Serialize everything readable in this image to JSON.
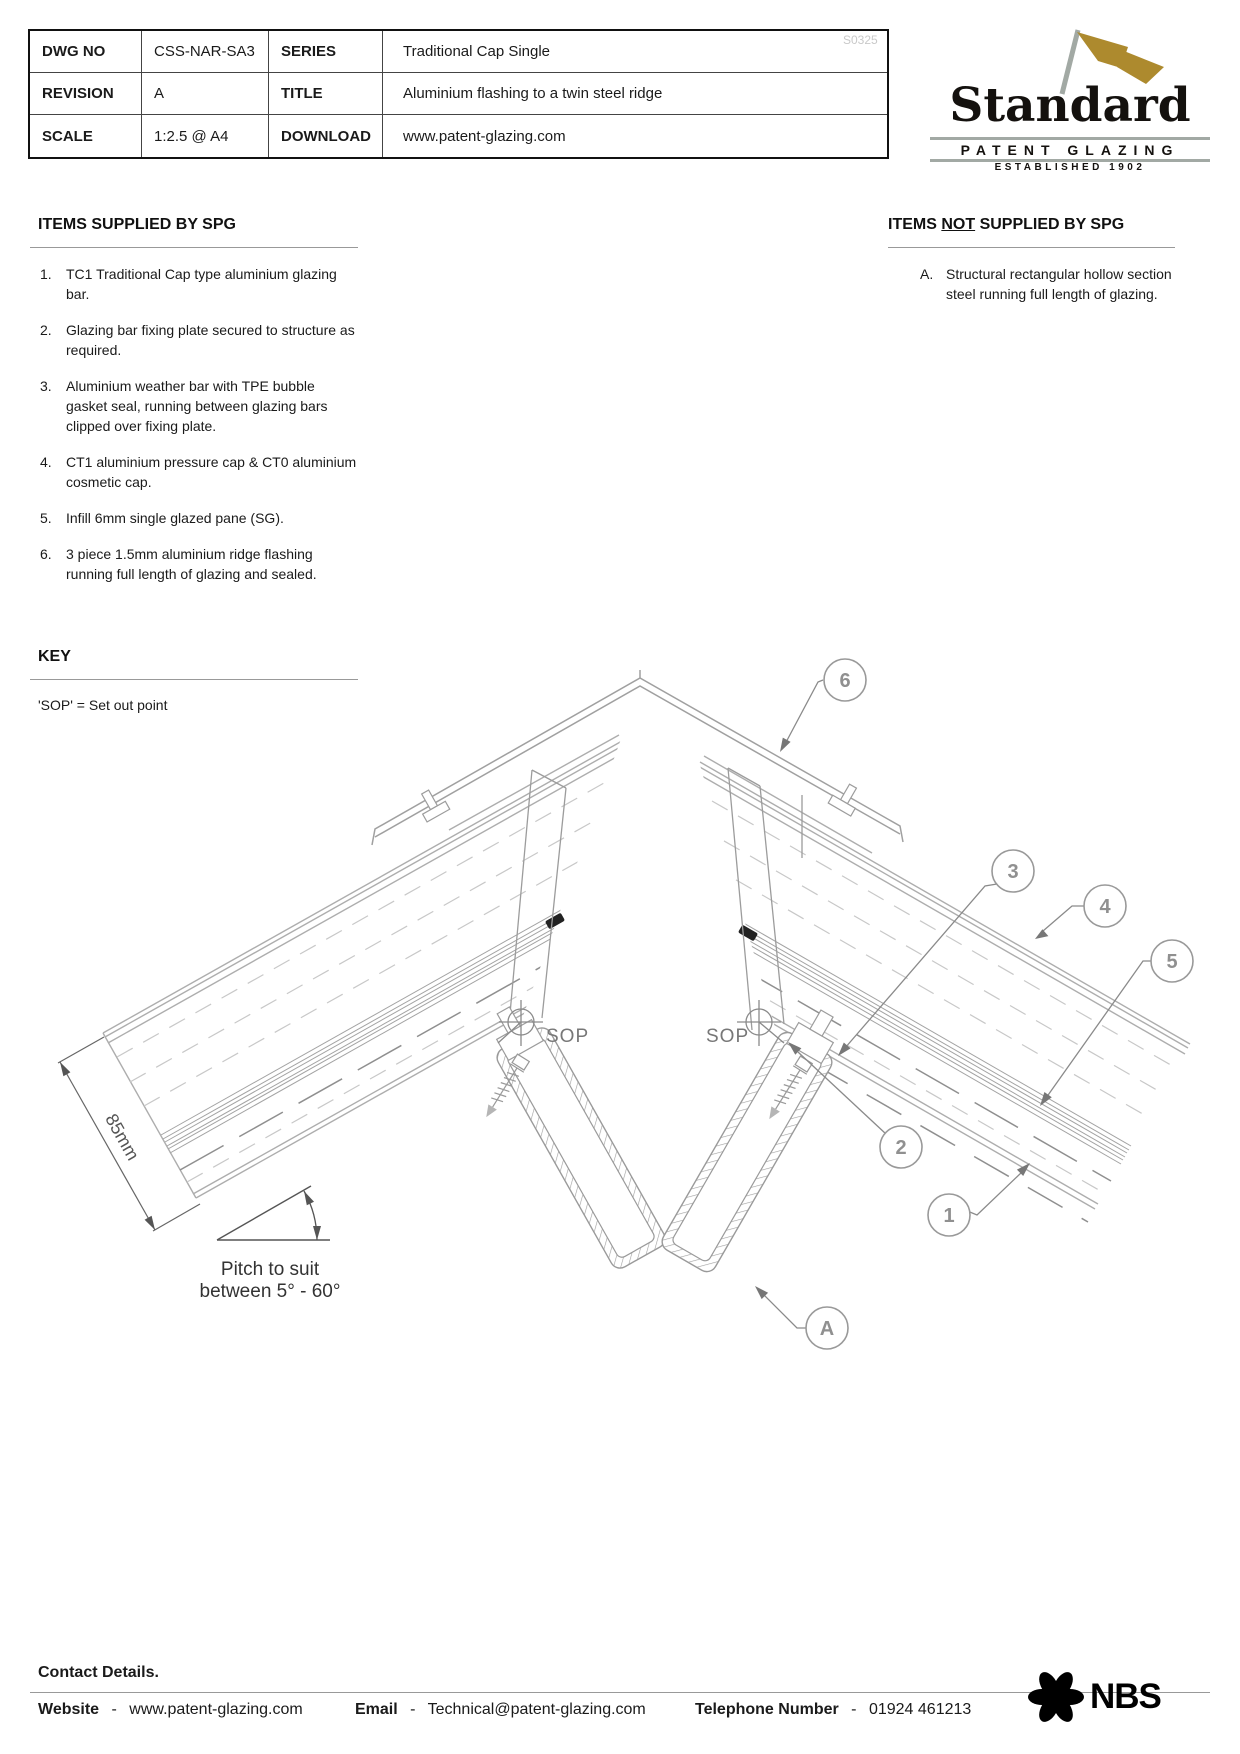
{
  "watermark": "S0325",
  "title_block": {
    "dwg_no_label": "DWG NO",
    "dwg_no": "CSS-NAR-SA3",
    "series_label": "SERIES",
    "series": "Traditional Cap Single",
    "revision_label": "REVISION",
    "revision": "A",
    "title_label": "TITLE",
    "title": "Aluminium flashing to a twin steel ridge",
    "scale_label": "SCALE",
    "scale": "1:2.5 @ A4",
    "download_label": "DOWNLOAD",
    "download": "www.patent-glazing.com"
  },
  "logo": {
    "name": "Standard",
    "subtitle": "PATENT GLAZING",
    "established": "ESTABLISHED 1902"
  },
  "supplied": {
    "heading": "ITEMS SUPPLIED BY SPG",
    "items": [
      {
        "num": "1.",
        "text": "TC1 Traditional Cap type aluminium glazing bar."
      },
      {
        "num": "2.",
        "text": "Glazing bar fixing plate secured to structure as required."
      },
      {
        "num": "3.",
        "text": "Aluminium weather bar with TPE bubble gasket seal, running between glazing bars clipped over fixing plate."
      },
      {
        "num": "4.",
        "text": "CT1 aluminium pressure cap & CT0 aluminium cosmetic cap."
      },
      {
        "num": "5.",
        "text": "Infill 6mm single glazed pane (SG)."
      },
      {
        "num": "6.",
        "text": "3 piece 1.5mm aluminium ridge flashing running full length of glazing and sealed."
      }
    ]
  },
  "not_supplied": {
    "heading_pre": "ITEMS ",
    "heading_not": "NOT",
    "heading_post": " SUPPLIED BY SPG",
    "items": [
      {
        "num": "A.",
        "text": "Structural  rectangular hollow section steel running full length of glazing."
      }
    ]
  },
  "key": {
    "heading": "KEY",
    "note": "'SOP' = Set out point"
  },
  "drawing": {
    "sop_label": "SOP",
    "dimension_label": "85mm",
    "pitch_line1": "Pitch to suit",
    "pitch_line2": "between 5° - 60°",
    "callouts": {
      "c1": "1",
      "c2": "2",
      "c3": "3",
      "c4": "4",
      "c5": "5",
      "c6": "6",
      "ca": "A"
    }
  },
  "footer": {
    "heading": "Contact Details.",
    "website_label": "Website",
    "website_sep": "-",
    "website": "www.patent-glazing.com",
    "email_label": "Email",
    "email_sep": "-",
    "email": "Technical@patent-glazing.com",
    "phone_label": "Telephone Number",
    "phone_sep": "-",
    "phone": "01924 461213",
    "nbs": "NBS"
  },
  "colors": {
    "logo_gold": "#ad8a2e",
    "logo_gray": "#a2a9a4",
    "cad_line": "#a8a8a8",
    "cad_dark": "#8a8a8a"
  }
}
